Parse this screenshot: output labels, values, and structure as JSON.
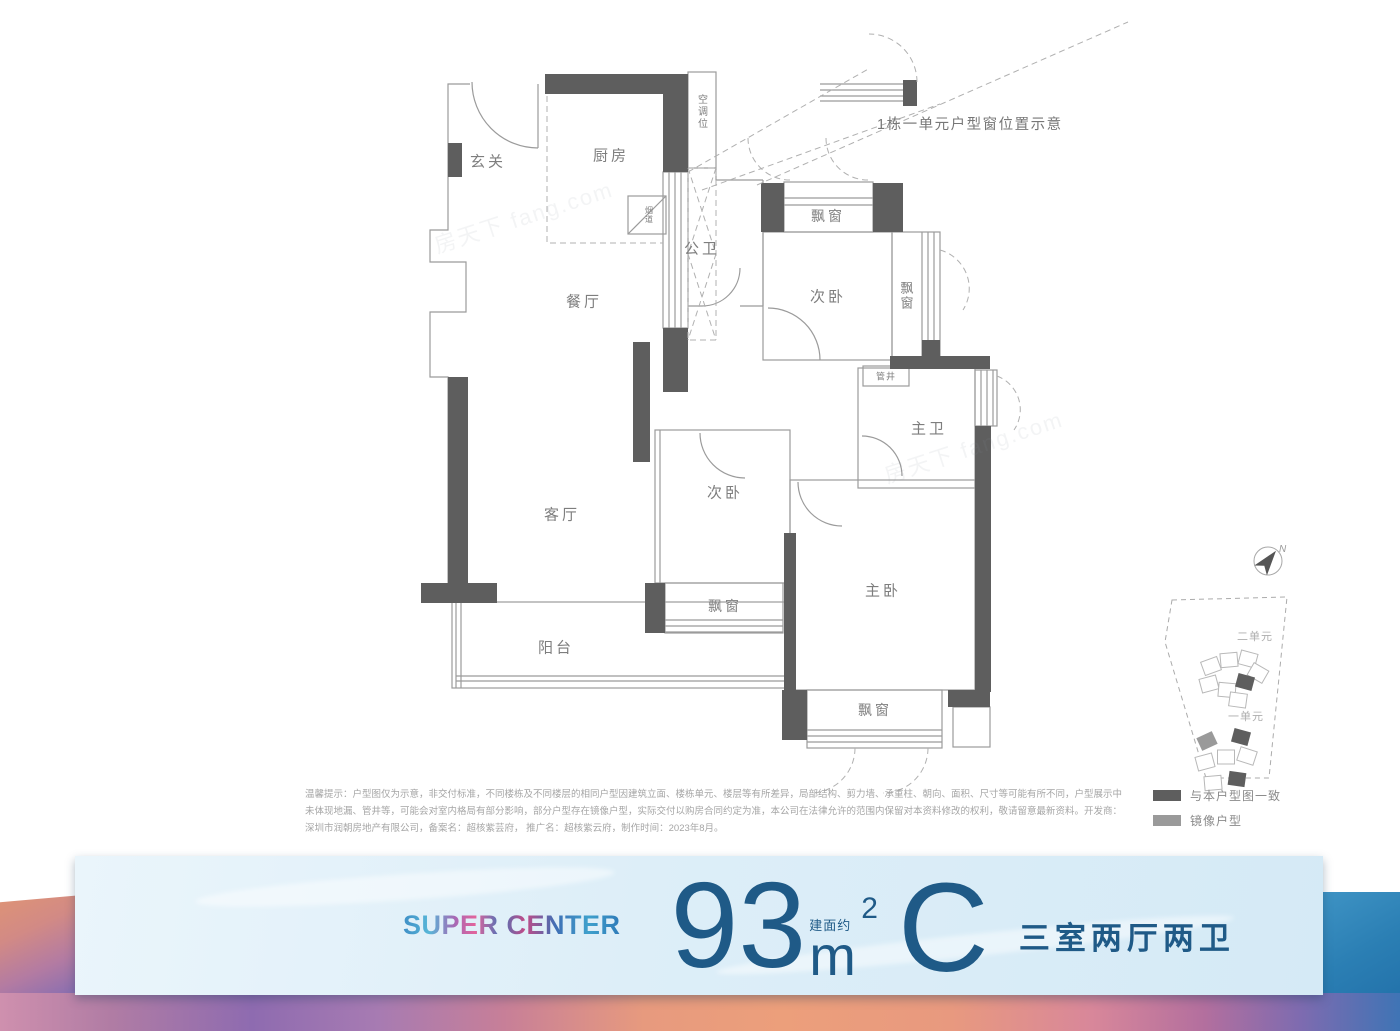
{
  "window_annotation": "1栋一单元户型窗位置示意",
  "watermark": "房天下 fang.com",
  "floorplan": {
    "wall_color": "#5e5e5e",
    "line_color": "#9b9b9b",
    "rooms": [
      {
        "label": "玄关"
      },
      {
        "label": "厨房"
      },
      {
        "label": "空调位"
      },
      {
        "label": "烟道"
      },
      {
        "label": "公卫"
      },
      {
        "label": "餐厅"
      },
      {
        "label": "飘窗"
      },
      {
        "label": "次卧"
      },
      {
        "label": "飘窗"
      },
      {
        "label": "管井"
      },
      {
        "label": "主卫"
      },
      {
        "label": "次卧"
      },
      {
        "label": "客厅"
      },
      {
        "label": "主卧"
      },
      {
        "label": "飘窗"
      },
      {
        "label": "阳台"
      },
      {
        "label": "飘窗"
      }
    ]
  },
  "siteplan": {
    "compass_label": "N",
    "clusters": [
      {
        "label": "二单元"
      },
      {
        "label": "一单元"
      }
    ],
    "legend": [
      {
        "label": "与本户型图一致",
        "color": "#5e5e5e",
        "swatch_style": "background:#5e5e5e"
      },
      {
        "label": "镜像户型",
        "color": "#9a9a9a",
        "swatch_style": "background:#9a9a9a"
      }
    ]
  },
  "disclaimer": {
    "lines": [
      "温馨提示：户型图仅为示意，非交付标准，不同楼栋及不同楼层的相同户型因建筑立面、楼栋单元、楼层等有所差异，局部结构、剪力墙、承重柱、朝向、面积、尺寸等可能有所不同，户型展示中",
      "未体现地漏、管井等，可能会对室内格局有部分影响，部分户型存在镜像户型，实际交付以购房合同约定为准，本公司在法律允许的范围内保留对本资料修改的权利，敬请留意最新资料。开发商：",
      "深圳市润朝房地产有限公司，备案名：超核紫芸府， 推广名：超核紫云府，制作时间：2023年8月。"
    ]
  },
  "banner": {
    "brand": "SUPER CENTER",
    "area_value": "93",
    "area_prefix": "建面约",
    "area_unit": "m",
    "area_superscript": "2",
    "unit_code": "C",
    "layout_text": "三室两厅两卫",
    "text_color": "#1f5a87"
  }
}
